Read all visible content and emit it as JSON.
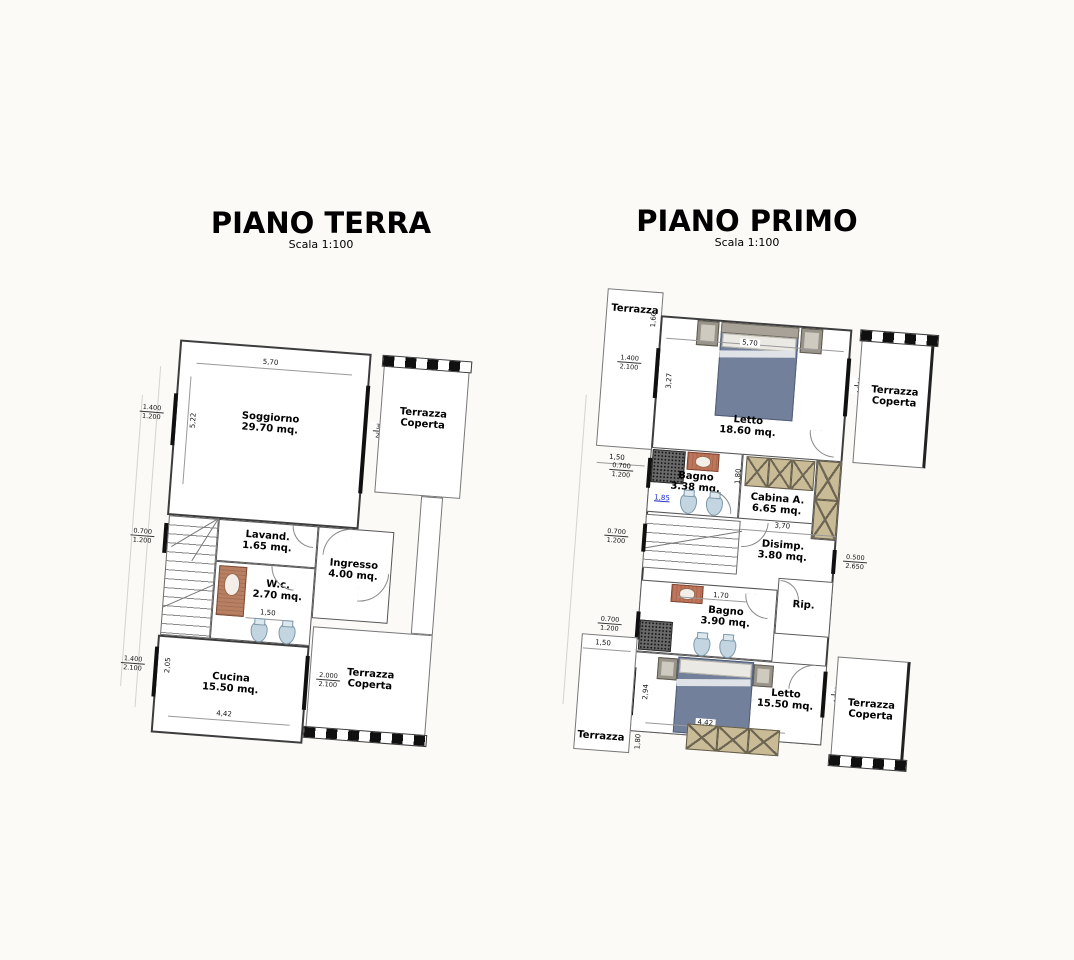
{
  "colors": {
    "bed": "#72809b",
    "wardrobe": "#c8bb95",
    "shower_dark": "#6a6a6a",
    "sink_red": "#c0755a",
    "fixture_blue": "#c3d5e1",
    "railing_black": "#101010",
    "selected_dim_blue": "#1726c9"
  },
  "ground_floor": {
    "title": "PIANO TERRA",
    "scale": "Scala 1:100",
    "rooms": {
      "soggiorno": {
        "name": "Soggiorno",
        "area": "29.70 mq."
      },
      "lavanderia": {
        "name": "Lavand.",
        "area": "1.65 mq."
      },
      "ingresso": {
        "name": "Ingresso",
        "area": "4.00 mq."
      },
      "wc": {
        "name": "W.c.",
        "area": "2.70 mq."
      },
      "cucina": {
        "name": "Cucina",
        "area": "15.50 mq."
      },
      "terrazza_coperta": {
        "name": "Terrazza",
        "name2": "Coperta"
      }
    },
    "dims": {
      "soggiorno_width": "5,70",
      "soggiorno_height": "5,22",
      "wc_width": "1,50",
      "cucina_width": "4,42",
      "cucina_height": "2,05"
    },
    "windows": {
      "soggiorno_left": {
        "w": "1.400",
        "h": "1.200"
      },
      "soggiorno_right": {
        "w": "3.000",
        "h": "2.100"
      },
      "stairs_left": {
        "w": "0.700",
        "h": "1.200"
      },
      "cucina_left": {
        "w": "1.400",
        "h": "2.100"
      },
      "cucina_right": {
        "w": "2.000",
        "h": "2.100"
      }
    }
  },
  "first_floor": {
    "title": "PIANO PRIMO",
    "scale": "Scala 1:100",
    "rooms": {
      "letto_grande": {
        "name": "Letto",
        "area": "18.60 mq."
      },
      "bagno_piccolo": {
        "name": "Bagno",
        "area": "3.38 mq."
      },
      "cabina_armadio": {
        "name": "Cabina A.",
        "area": "6.65 mq."
      },
      "disimpegno": {
        "name": "Disimp.",
        "area": "3.80 mq."
      },
      "ripostiglio": {
        "name": "Rip."
      },
      "bagno_grande": {
        "name": "Bagno",
        "area": "3.90 mq."
      },
      "letto_piccolo": {
        "name": "Letto",
        "area": "15.50 mq."
      },
      "terrazza": {
        "name": "Terrazza"
      },
      "terrazza_coperta": {
        "name": "Terrazza",
        "name2": "Coperta"
      }
    },
    "dims": {
      "letto_grande_width": "5,70",
      "letto_grande_height": "3,27",
      "terrazza_top_depth": "1,60",
      "offset_top": "1,50",
      "bagno_piccolo_width": "1,85",
      "bagno_piccolo_height": "1,80",
      "cabina_width": "3,70",
      "bagno_grande_width": "1,70",
      "letto_piccolo_width": "4,42",
      "letto_piccolo_height": "2,94",
      "offset_bottom": "1,50",
      "terrazza_bottom_depth": "1,80"
    },
    "windows": {
      "letto_grande_left": {
        "w": "1.400",
        "h": "2.100"
      },
      "letto_grande_right": {
        "w": "2.000",
        "h": "2.100"
      },
      "bagno_piccolo_left": {
        "w": "0.700",
        "h": "1.200"
      },
      "stairs_left": {
        "w": "0.700",
        "h": "1.200"
      },
      "disimpegno_right": {
        "w": "0.500",
        "h": "2.650"
      },
      "bagno_grande_left": {
        "w": "0.700",
        "h": "1.200"
      },
      "letto_piccolo_left": {
        "w": "1.400",
        "h": "2.100"
      },
      "letto_piccolo_right": {
        "w": "2.000",
        "h": "2.100"
      }
    }
  }
}
